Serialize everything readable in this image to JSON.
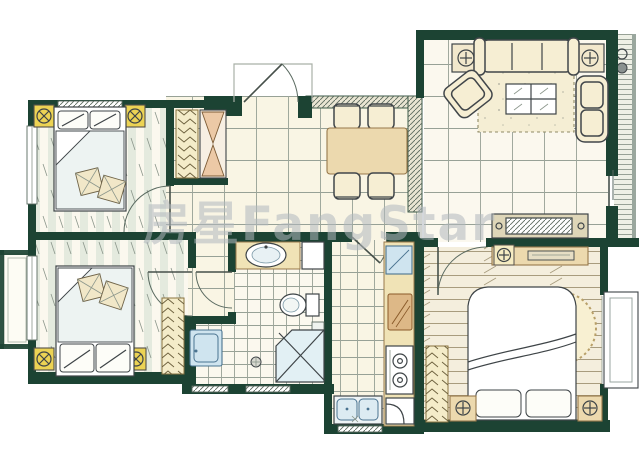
{
  "watermark": {
    "text": "房星FangStar"
  },
  "palette": {
    "wall": "#1c4333",
    "floor": "#f9f5e4",
    "floor-bright": "#fbf8ee",
    "tile-line": "#97a196",
    "stripe": "#e4eade",
    "wood-line": "#a89c7e",
    "ink": "#3e4447",
    "tan": "#ecd9ae",
    "tan-dark": "#97784b",
    "counter": "#f0e3b6",
    "accent-yellow": "#ecd354",
    "blue-fill": "#cfe4ef",
    "blue-stroke": "#4a7390",
    "sofa": "#f6eed3",
    "rug": "#f5eed4",
    "watermark": "#b2b8be"
  },
  "plan": {
    "type": "apartment-floor-plan",
    "rooms": [
      {
        "id": "bedroom-1",
        "furniture": [
          "double-bed",
          "pillows",
          "pillar-marker",
          "pillar-marker",
          "window",
          "door"
        ]
      },
      {
        "id": "bedroom-2",
        "furniture": [
          "double-bed",
          "pillows",
          "pillar-marker",
          "pillar-marker",
          "wardrobe",
          "balcony",
          "door"
        ]
      },
      {
        "id": "entry-hall",
        "furniture": [
          "entry-door",
          "coat-closet",
          "shoe-cabinet"
        ]
      },
      {
        "id": "dining-room",
        "furniture": [
          "dining-table",
          "chair",
          "chair",
          "chair",
          "chair"
        ]
      },
      {
        "id": "living-room",
        "furniture": [
          "three-seat-sofa",
          "armchair",
          "armchair",
          "side-table-lamp",
          "side-table-lamp",
          "rug",
          "coffee-table",
          "tv-cabinet"
        ]
      },
      {
        "id": "balcony",
        "furniture": [
          "decking",
          "drain-fittings"
        ]
      },
      {
        "id": "bathroom",
        "furniture": [
          "vanity-sink",
          "toilet",
          "corner-shower",
          "washing-machine",
          "floor-drain",
          "door"
        ]
      },
      {
        "id": "kitchen",
        "furniture": [
          "counter",
          "sink-basin",
          "cutting-board",
          "two-burner-stove",
          "corner-cabinet",
          "double-sink",
          "door"
        ]
      },
      {
        "id": "master-bedroom",
        "furniture": [
          "double-bed",
          "round-rug",
          "nightstand-lamp",
          "nightstand-lamp",
          "dresser",
          "wardrobe",
          "bay-window",
          "door"
        ]
      }
    ]
  }
}
